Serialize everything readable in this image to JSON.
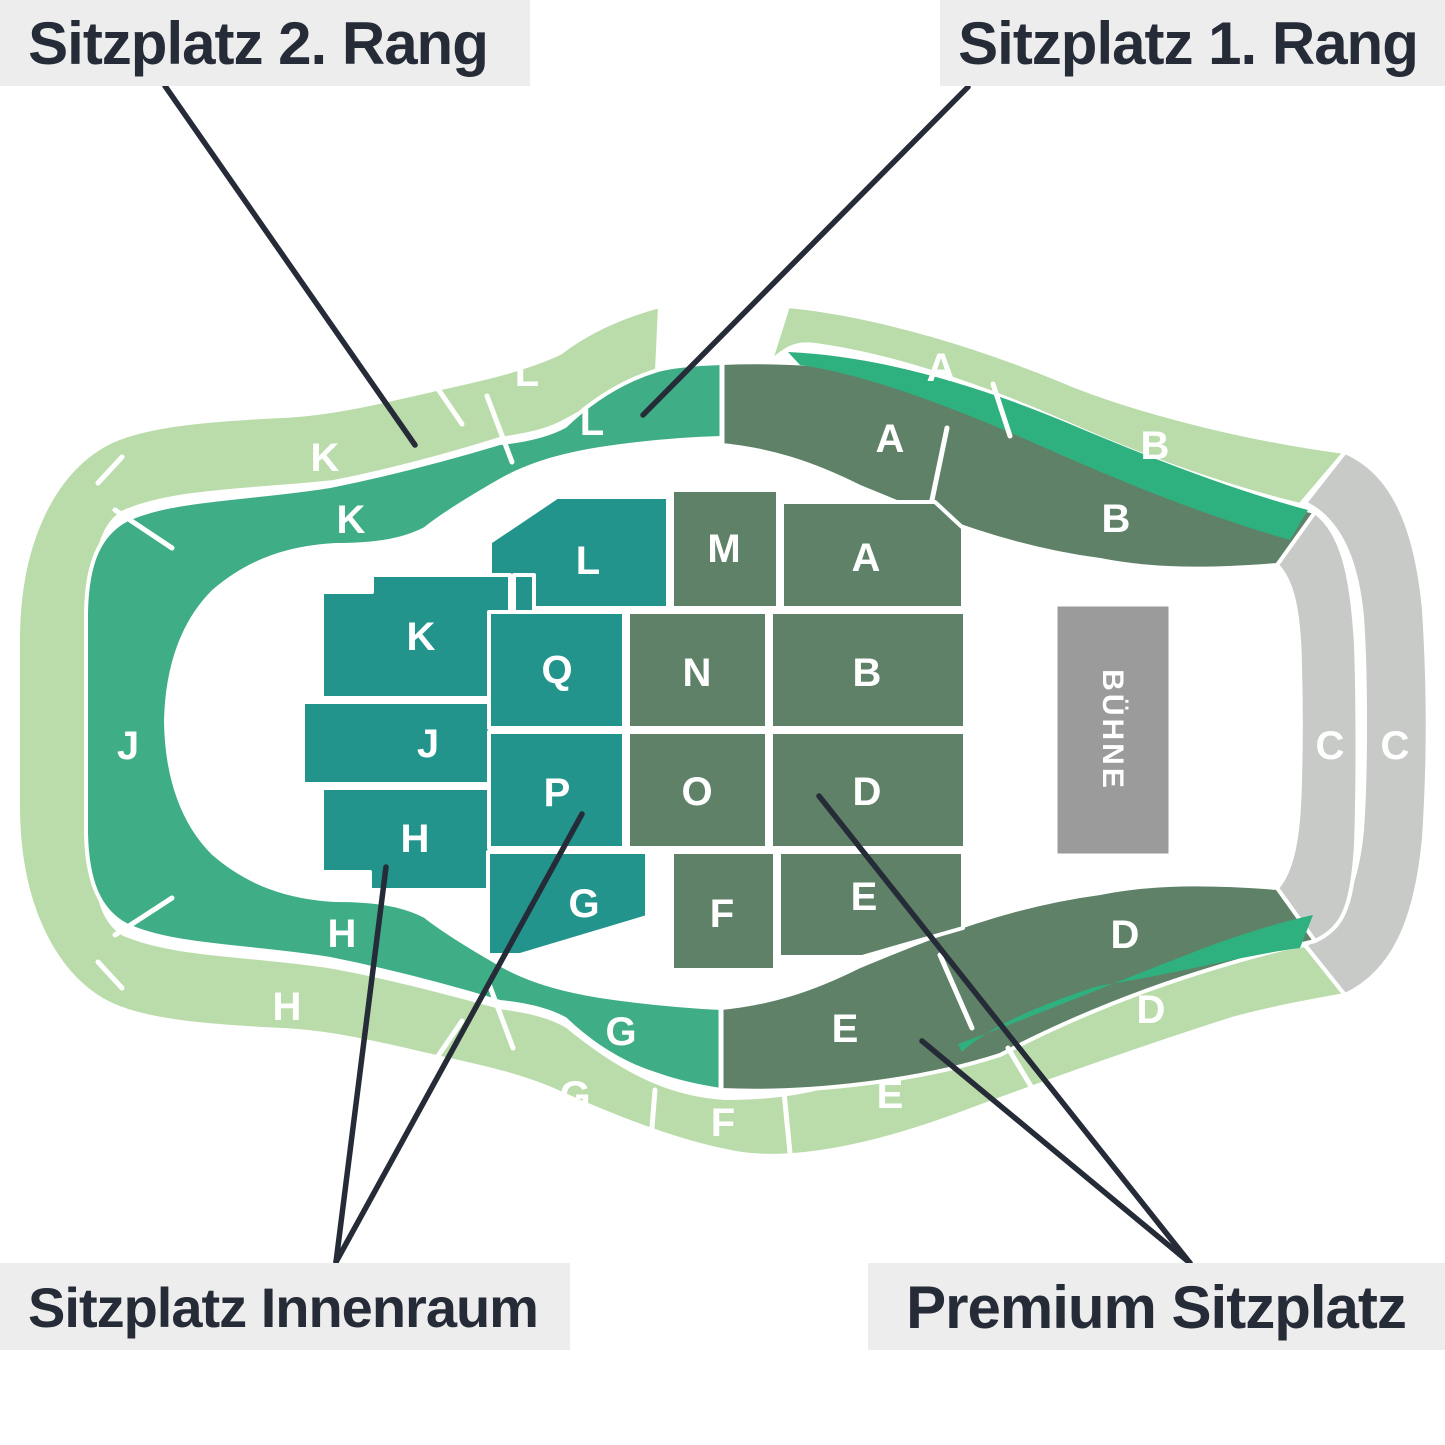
{
  "callouts": {
    "top_left": {
      "label": "Sitzplatz 2. Rang",
      "color": "#badcaa"
    },
    "top_right": {
      "label": "Sitzplatz 1. Rang",
      "color": "#3fae86"
    },
    "bottom_left": {
      "label": "Sitzplatz Innenraum",
      "color": "#23948c"
    },
    "bottom_right": {
      "label": "Premium Sitzplatz",
      "color": "#5e8167"
    }
  },
  "stage": {
    "label": "BÜHNE"
  },
  "colors": {
    "rang2_light_green": "#badcaa",
    "rang1_green": "#3fae86",
    "rang1_bright_strip": "#2eb17f",
    "premium_sage": "#5e8167",
    "innenraum_teal": "#23948c",
    "gallery_gray": "#c8cac8",
    "stage_gray": "#9b9b9b",
    "callout_bg": "#ededed",
    "text_dark": "#262b38"
  },
  "sections": {
    "ring_outer": [
      {
        "label": "L"
      },
      {
        "label": "K"
      },
      {
        "label": "A"
      },
      {
        "label": "B"
      },
      {
        "label": "H"
      },
      {
        "label": "G"
      },
      {
        "label": "F"
      },
      {
        "label": "E"
      },
      {
        "label": "D"
      }
    ],
    "ring_inner": [
      {
        "label": "K"
      },
      {
        "label": "L"
      },
      {
        "label": "J"
      },
      {
        "label": "H"
      },
      {
        "label": "G"
      }
    ],
    "ring_premium": [
      {
        "label": "A"
      },
      {
        "label": "B"
      },
      {
        "label": "E"
      },
      {
        "label": "D"
      }
    ],
    "gallery": [
      {
        "label": "C"
      },
      {
        "label": "C"
      }
    ],
    "floor_inner": [
      {
        "label": "L"
      },
      {
        "label": "K"
      },
      {
        "label": "J"
      },
      {
        "label": "H"
      },
      {
        "label": "Q"
      },
      {
        "label": "P"
      },
      {
        "label": "G"
      }
    ],
    "floor_premium": [
      {
        "label": "M"
      },
      {
        "label": "A"
      },
      {
        "label": "N"
      },
      {
        "label": "B"
      },
      {
        "label": "O"
      },
      {
        "label": "D"
      },
      {
        "label": "F"
      },
      {
        "label": "E"
      }
    ]
  }
}
